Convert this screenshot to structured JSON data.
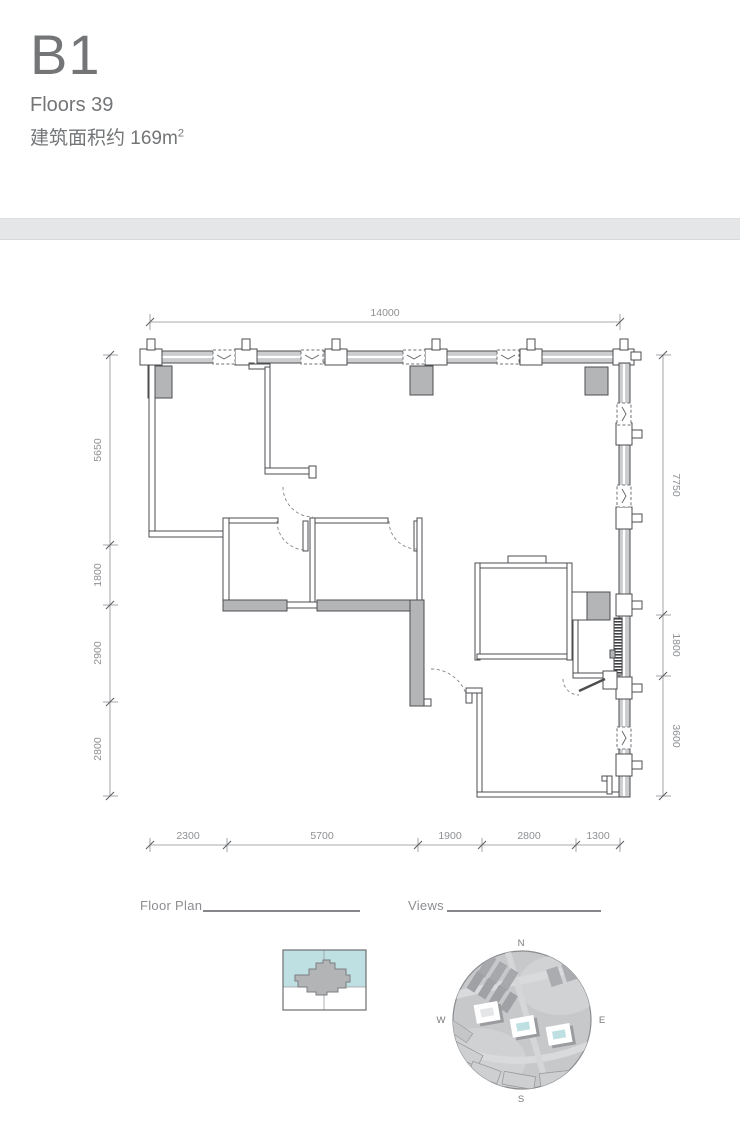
{
  "header": {
    "unit": "B1",
    "floors": "Floors 39",
    "area_prefix": "建筑面积约 169m",
    "area_sup": "2"
  },
  "dimensions": {
    "top": [
      "14000"
    ],
    "bottom": [
      "2300",
      "5700",
      "1900",
      "2800",
      "1300"
    ],
    "left": [
      "5650",
      "1800",
      "2900",
      "2800"
    ],
    "right": [
      "7750",
      "1800",
      "3600"
    ]
  },
  "footer": {
    "floor_plan_label": "Floor Plan",
    "views_label": "Views"
  },
  "compass": {
    "north": "N",
    "east": "E",
    "south": "S",
    "west": "W"
  },
  "colors": {
    "accent_teal": "#bfe0e3",
    "wall_gray": "#b3b5b7",
    "line_dark": "#4d4e50",
    "dim_gray": "#8e9093",
    "divider_band": "#e5e6e8"
  }
}
